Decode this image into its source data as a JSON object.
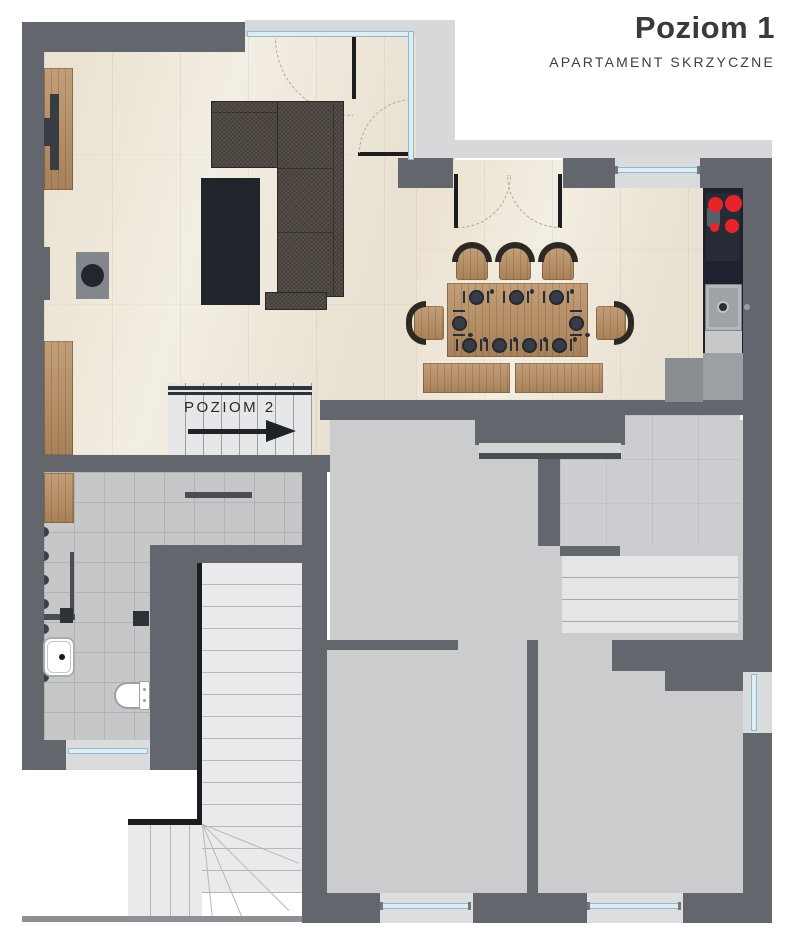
{
  "header": {
    "title": "Poziom 1",
    "subtitle": "APARTAMENT SKRZYCZNE"
  },
  "stairs_up": {
    "label": "POZIOM 2"
  },
  "colors": {
    "wall": "#63666c",
    "wood_floor": "#f3eee3",
    "tile_floor": "#c6c7c9",
    "room_floor": "#cbccce",
    "stair_floor": "#e9eaec",
    "kitchen_counter": "#1d222e",
    "burner_red": "#e8242b",
    "window_glass": "#dcedf4",
    "window_frame": "#93b8c9",
    "furniture_wood": "#b98f63",
    "sofa": "#4f4842",
    "dark_accent": "#1b1d21",
    "title_text": "#3a3a3c"
  },
  "fixtures": {
    "living_room": [
      "tv-cabinet",
      "tv",
      "fireplace",
      "corner-sofa",
      "coffee-table",
      "sideboard"
    ],
    "dining": {
      "place_settings": 9,
      "arch_chairs": 5,
      "benches": 2,
      "table": "wood-dining-table"
    },
    "kitchen": [
      "cooktop-4-burners",
      "kitchen-sink",
      "counter"
    ],
    "entry_hall": [
      "wardrobe",
      "coat-rail",
      "coat-hooks"
    ],
    "bathroom": [
      "washbasin",
      "toilet"
    ],
    "circulation": [
      "stairs-up-to-level-2",
      "stairs-down",
      "closet-shelves"
    ]
  }
}
